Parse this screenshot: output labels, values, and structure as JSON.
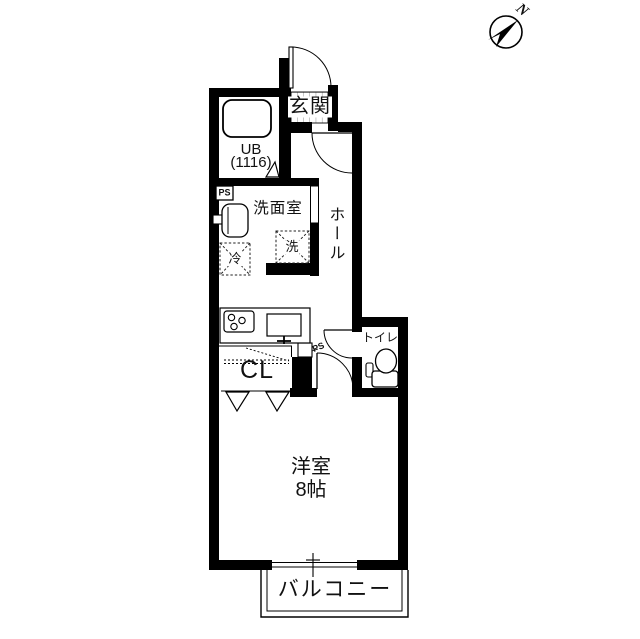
{
  "compass": {
    "north": "N"
  },
  "labels": {
    "entrance": "玄関",
    "unit_bath": "UB",
    "unit_bath_size": "(1116)",
    "pipe_space_top": "PS",
    "washroom": "洗面室",
    "washing_machine": "洗",
    "refrigerator": "冷",
    "hall": "ホール",
    "toilet": "トイレ",
    "closet": "CL",
    "pipe_space_middle": "PS",
    "western_room": "洋室",
    "western_room_size": "8帖",
    "balcony": "バルコニー"
  }
}
